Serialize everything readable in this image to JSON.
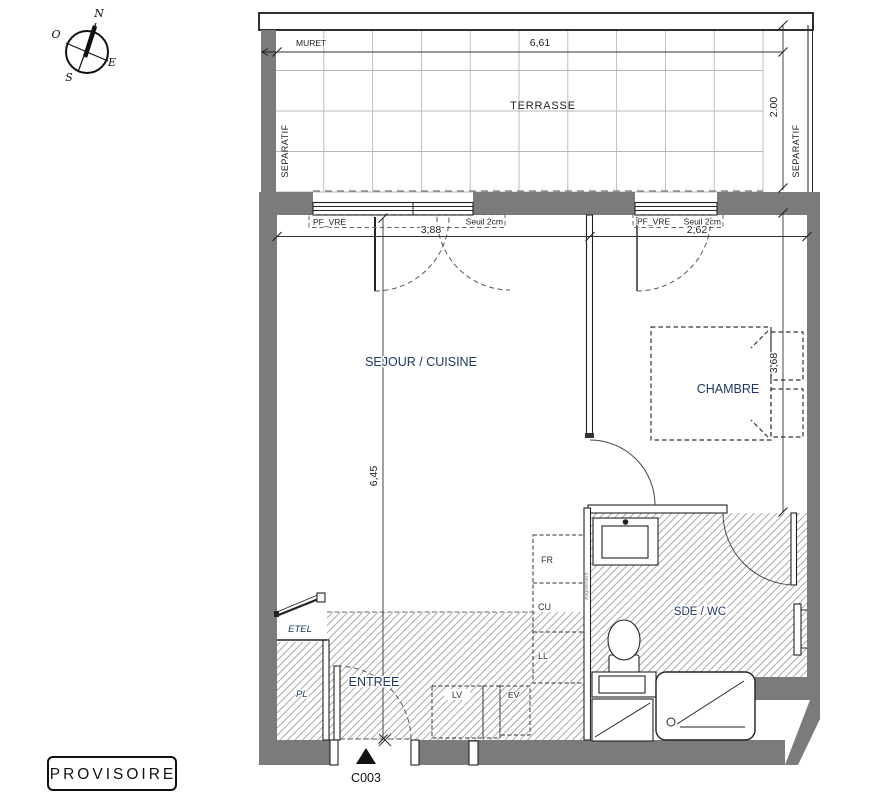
{
  "stamp": {
    "label": "PROVISOIRE"
  },
  "compass": {
    "north": "N",
    "south": "S",
    "east": "E",
    "west": "O"
  },
  "terrace": {
    "label": "TERRASSE",
    "muret_label": "MURET",
    "separatif_left": "SEPARATIF",
    "separatif_right": "SEPARATIF",
    "width_dim": "6,61",
    "depth_dim": "2.00"
  },
  "rooms": {
    "living": "SEJOUR / CUISINE",
    "bedroom": "CHAMBRE",
    "bathroom": "SDE / WC",
    "entry": "ENTREE",
    "closet": "PL",
    "elec_box": "ETEL"
  },
  "windows": {
    "left": {
      "label": "PF_VRE",
      "sill": "Seuil 2cm",
      "width_dim": "3,88"
    },
    "right": {
      "label": "PF_VRE",
      "sill": "Seuil 2cm",
      "width_dim": "2,62"
    }
  },
  "dims": {
    "living_depth": "6,45",
    "bedroom_depth": "3,68"
  },
  "appliances": {
    "fridge": "FR",
    "cooktop": "CU",
    "washer": "LL",
    "dishwasher": "LV",
    "sink": "EV"
  },
  "annotations": {
    "alignment": "Alignement",
    "door_code": "C003"
  },
  "colors": {
    "wall": "#7b7b7b",
    "line": "#222222",
    "room_label": "#1f3864",
    "terrace_grid": "#b8b8b8",
    "hatch": "#9b9b9b",
    "ev_highlight": "#ecedc3"
  }
}
